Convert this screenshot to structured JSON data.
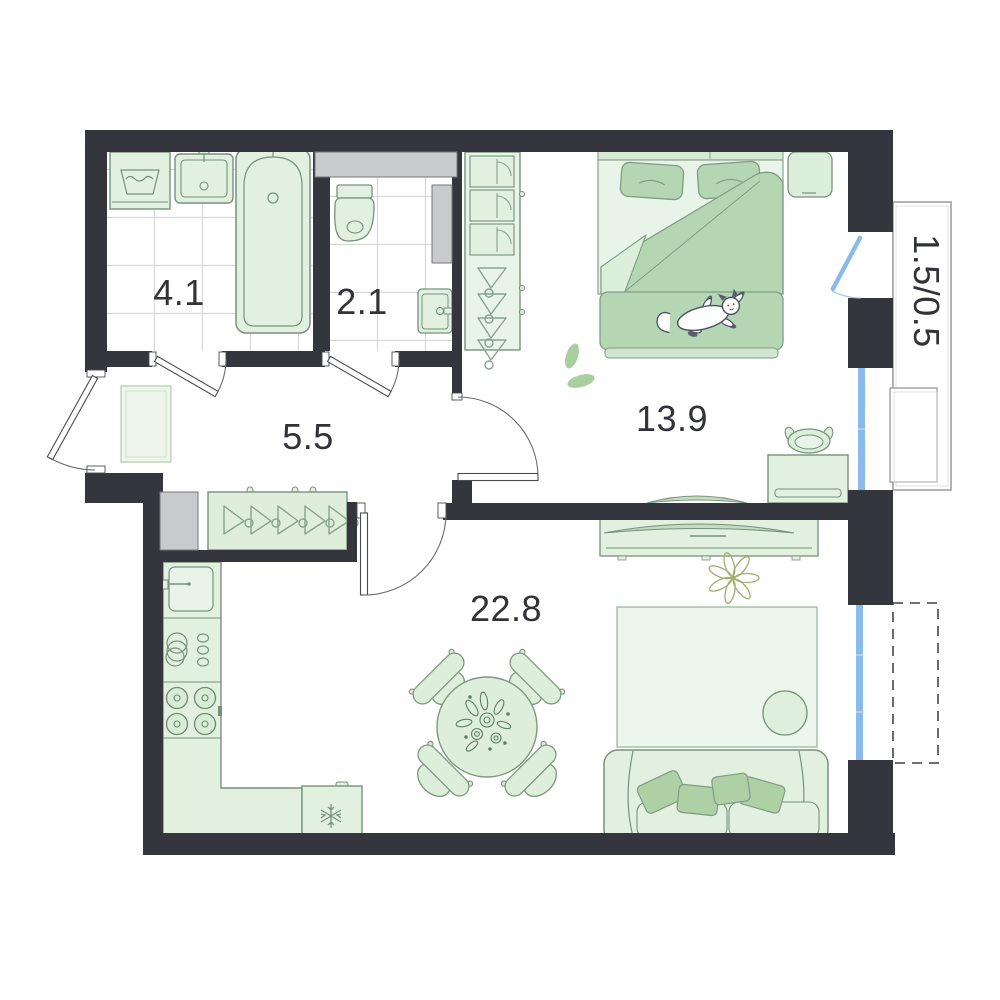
{
  "floorplan": {
    "rooms": [
      {
        "name": "bathroom",
        "area_label": "4.1"
      },
      {
        "name": "toilet",
        "area_label": "2.1"
      },
      {
        "name": "hallway",
        "area_label": "5.5"
      },
      {
        "name": "bedroom",
        "area_label": "13.9"
      },
      {
        "name": "living-kitchen",
        "area_label": "22.8"
      },
      {
        "name": "balcony",
        "area_label": "1.5/0.5"
      }
    ],
    "colors": {
      "wall": "#35363d",
      "furniture_fill": "#e2f0e0",
      "furniture_fill_light": "#e9f4e8",
      "furniture_stroke": "#77917d",
      "accent_green": "#b5d6b2",
      "window_blue": "#8ab9ec",
      "shaft_gray": "#c9cacb",
      "balcony_outline": "#a0a0a0",
      "tile_line": "#d6d6d6",
      "text": "#323339"
    },
    "icons": [
      "washing-machine-icon",
      "bathroom-sink-icon",
      "bathtub-icon",
      "toilet-icon",
      "hand-sink-icon",
      "entry-rug-icon",
      "hallway-closet-icon",
      "hanger-icon",
      "shaft-block",
      "kitchen-sink-icon",
      "dish-rack-icon",
      "stove-icon",
      "fridge-icon",
      "snowflake-icon",
      "dining-table-icon",
      "dining-chair-icon",
      "bouquet-icon",
      "wardrobe-icon",
      "bed-icon",
      "pillow-icon",
      "blanket-icon",
      "cat-icon",
      "nightstand-icon",
      "desk-icon",
      "desk-chair-icon",
      "bedroom-tv-icon",
      "tv-icon",
      "tv-console-icon",
      "flower-plant-icon",
      "living-rug-icon",
      "pouf-icon",
      "sofa-icon",
      "balcony-cabinet-icon",
      "entrance-door-icon",
      "interior-door-icon",
      "balcony-door-icon",
      "window-icon",
      "future-balcony-outline"
    ]
  }
}
